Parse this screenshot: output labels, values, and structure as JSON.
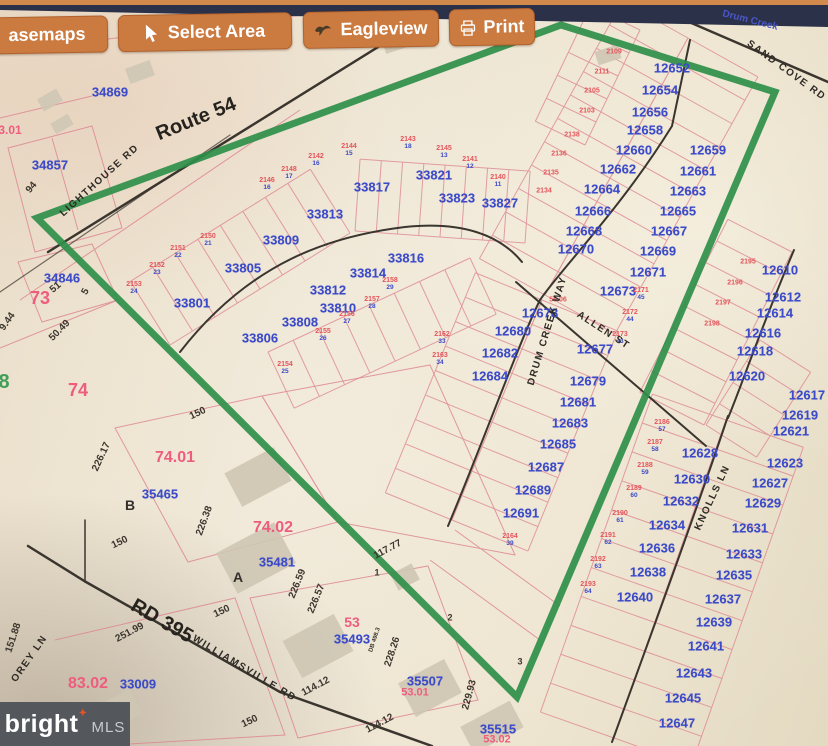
{
  "toolbar": {
    "buttons": [
      {
        "label": "asemaps",
        "icon": "none"
      },
      {
        "label": "Select Area",
        "icon": "cursor"
      },
      {
        "label": "Eagleview",
        "icon": "eagle"
      },
      {
        "label": "Print",
        "icon": "printer"
      }
    ]
  },
  "watermark": {
    "brand": "bright",
    "star": "✦",
    "suffix": "MLS"
  },
  "selection": {
    "points": [
      [
        561,
        25
      ],
      [
        775,
        92
      ],
      [
        517,
        697
      ],
      [
        37,
        218
      ]
    ],
    "color": "#2f8f4a",
    "width": 7
  },
  "colors": {
    "parcel_blue": "#3b4ac8",
    "lot_red": "#e4555c",
    "section_pink": "#ee5c7e",
    "toolbar_orange": "#cb7a40",
    "top_band_navy": "#2b3149",
    "paper_tan": "#ece3d0"
  },
  "map_labels": {
    "parcels": [
      {
        "t": "34869",
        "x": 110,
        "y": 92
      },
      {
        "t": "34857",
        "x": 50,
        "y": 165
      },
      {
        "t": "34846",
        "x": 62,
        "y": 278
      },
      {
        "t": "33801",
        "x": 192,
        "y": 303
      },
      {
        "t": "33805",
        "x": 243,
        "y": 268
      },
      {
        "t": "33809",
        "x": 281,
        "y": 240
      },
      {
        "t": "33813",
        "x": 325,
        "y": 214
      },
      {
        "t": "33817",
        "x": 372,
        "y": 187
      },
      {
        "t": "33821",
        "x": 434,
        "y": 175
      },
      {
        "t": "33823",
        "x": 457,
        "y": 198
      },
      {
        "t": "33827",
        "x": 500,
        "y": 203
      },
      {
        "t": "33806",
        "x": 260,
        "y": 338
      },
      {
        "t": "33808",
        "x": 300,
        "y": 322
      },
      {
        "t": "33810",
        "x": 338,
        "y": 308
      },
      {
        "t": "33812",
        "x": 328,
        "y": 290
      },
      {
        "t": "33814",
        "x": 368,
        "y": 273
      },
      {
        "t": "33816",
        "x": 406,
        "y": 258
      },
      {
        "t": "12652",
        "x": 672,
        "y": 68
      },
      {
        "t": "12654",
        "x": 660,
        "y": 90
      },
      {
        "t": "12656",
        "x": 650,
        "y": 112
      },
      {
        "t": "12658",
        "x": 645,
        "y": 130
      },
      {
        "t": "12660",
        "x": 634,
        "y": 150
      },
      {
        "t": "12662",
        "x": 618,
        "y": 169
      },
      {
        "t": "12664",
        "x": 602,
        "y": 189
      },
      {
        "t": "12666",
        "x": 593,
        "y": 211
      },
      {
        "t": "12668",
        "x": 584,
        "y": 231
      },
      {
        "t": "12670",
        "x": 576,
        "y": 249
      },
      {
        "t": "12659",
        "x": 708,
        "y": 150
      },
      {
        "t": "12661",
        "x": 698,
        "y": 171
      },
      {
        "t": "12663",
        "x": 688,
        "y": 191
      },
      {
        "t": "12665",
        "x": 678,
        "y": 211
      },
      {
        "t": "12667",
        "x": 669,
        "y": 231
      },
      {
        "t": "12669",
        "x": 658,
        "y": 251
      },
      {
        "t": "12671",
        "x": 648,
        "y": 272
      },
      {
        "t": "12673",
        "x": 618,
        "y": 291
      },
      {
        "t": "12677",
        "x": 595,
        "y": 349
      },
      {
        "t": "12678",
        "x": 540,
        "y": 313
      },
      {
        "t": "12680",
        "x": 513,
        "y": 331
      },
      {
        "t": "12682",
        "x": 500,
        "y": 353
      },
      {
        "t": "12684",
        "x": 490,
        "y": 376
      },
      {
        "t": "12679",
        "x": 588,
        "y": 381
      },
      {
        "t": "12681",
        "x": 578,
        "y": 402
      },
      {
        "t": "12683",
        "x": 570,
        "y": 423
      },
      {
        "t": "12685",
        "x": 558,
        "y": 444
      },
      {
        "t": "12687",
        "x": 546,
        "y": 467
      },
      {
        "t": "12689",
        "x": 533,
        "y": 490
      },
      {
        "t": "12691",
        "x": 521,
        "y": 513
      },
      {
        "t": "12610",
        "x": 780,
        "y": 270
      },
      {
        "t": "12612",
        "x": 783,
        "y": 297
      },
      {
        "t": "12614",
        "x": 775,
        "y": 313
      },
      {
        "t": "12616",
        "x": 763,
        "y": 333
      },
      {
        "t": "12618",
        "x": 755,
        "y": 351
      },
      {
        "t": "12620",
        "x": 747,
        "y": 376
      },
      {
        "t": "12617",
        "x": 807,
        "y": 395
      },
      {
        "t": "12619",
        "x": 800,
        "y": 415
      },
      {
        "t": "12621",
        "x": 791,
        "y": 431
      },
      {
        "t": "12623",
        "x": 785,
        "y": 463
      },
      {
        "t": "12627",
        "x": 770,
        "y": 483
      },
      {
        "t": "12629",
        "x": 763,
        "y": 503
      },
      {
        "t": "12631",
        "x": 750,
        "y": 528
      },
      {
        "t": "12633",
        "x": 744,
        "y": 554
      },
      {
        "t": "12635",
        "x": 734,
        "y": 575
      },
      {
        "t": "12637",
        "x": 723,
        "y": 599
      },
      {
        "t": "12639",
        "x": 714,
        "y": 622
      },
      {
        "t": "12641",
        "x": 706,
        "y": 646
      },
      {
        "t": "12643",
        "x": 694,
        "y": 673
      },
      {
        "t": "12645",
        "x": 683,
        "y": 698
      },
      {
        "t": "12647",
        "x": 677,
        "y": 723
      },
      {
        "t": "12628",
        "x": 700,
        "y": 453
      },
      {
        "t": "12630",
        "x": 692,
        "y": 479
      },
      {
        "t": "12632",
        "x": 681,
        "y": 501
      },
      {
        "t": "12634",
        "x": 667,
        "y": 525
      },
      {
        "t": "12636",
        "x": 657,
        "y": 548
      },
      {
        "t": "12638",
        "x": 648,
        "y": 572
      },
      {
        "t": "12640",
        "x": 635,
        "y": 597
      },
      {
        "t": "35465",
        "x": 160,
        "y": 494
      },
      {
        "t": "35481",
        "x": 277,
        "y": 562
      },
      {
        "t": "35493",
        "x": 352,
        "y": 639
      },
      {
        "t": "35507",
        "x": 425,
        "y": 681
      },
      {
        "t": "35515",
        "x": 498,
        "y": 729
      },
      {
        "t": "33009",
        "x": 138,
        "y": 684
      }
    ],
    "sections": [
      {
        "t": "3.01",
        "x": 10,
        "y": 130,
        "s": 12
      },
      {
        "t": "73",
        "x": 40,
        "y": 298,
        "s": 18
      },
      {
        "t": "74",
        "x": 78,
        "y": 390,
        "s": 18
      },
      {
        "t": "74.01",
        "x": 175,
        "y": 458,
        "s": 16
      },
      {
        "t": "74.02",
        "x": 273,
        "y": 528,
        "s": 16
      },
      {
        "t": "53",
        "x": 352,
        "y": 622,
        "s": 14
      },
      {
        "t": "83.02",
        "x": 88,
        "y": 684,
        "s": 16
      },
      {
        "t": "53.01",
        "x": 415,
        "y": 693,
        "s": 11
      },
      {
        "t": "53.02",
        "x": 497,
        "y": 740,
        "s": 11
      }
    ],
    "lots": [
      {
        "t": "2146",
        "x": 267,
        "y": 184,
        "b": "16"
      },
      {
        "t": "2148",
        "x": 289,
        "y": 173,
        "b": "17"
      },
      {
        "t": "2142",
        "x": 316,
        "y": 160,
        "b": "16"
      },
      {
        "t": "2144",
        "x": 349,
        "y": 150,
        "b": "15"
      },
      {
        "t": "2143",
        "x": 408,
        "y": 143,
        "b": "18"
      },
      {
        "t": "2145",
        "x": 444,
        "y": 152,
        "b": "13"
      },
      {
        "t": "2141",
        "x": 470,
        "y": 163,
        "b": "12"
      },
      {
        "t": "2140",
        "x": 498,
        "y": 181,
        "b": "11"
      },
      {
        "t": "2150",
        "x": 208,
        "y": 240,
        "b": "21"
      },
      {
        "t": "2151",
        "x": 178,
        "y": 252,
        "b": "22"
      },
      {
        "t": "2152",
        "x": 157,
        "y": 269,
        "b": "23"
      },
      {
        "t": "2153",
        "x": 134,
        "y": 288,
        "b": "24"
      },
      {
        "t": "2158",
        "x": 390,
        "y": 284,
        "b": "29"
      },
      {
        "t": "2157",
        "x": 372,
        "y": 303,
        "b": "28"
      },
      {
        "t": "2156",
        "x": 347,
        "y": 318,
        "b": "27"
      },
      {
        "t": "2155",
        "x": 323,
        "y": 335,
        "b": "26"
      },
      {
        "t": "2154",
        "x": 285,
        "y": 368,
        "b": "25"
      },
      {
        "t": "2162",
        "x": 442,
        "y": 338,
        "b": "33"
      },
      {
        "t": "2163",
        "x": 440,
        "y": 359,
        "b": "34"
      },
      {
        "t": "2164",
        "x": 510,
        "y": 540,
        "b": "39"
      },
      {
        "t": "2109",
        "x": 614,
        "y": 52
      },
      {
        "t": "2111",
        "x": 602,
        "y": 72
      },
      {
        "t": "2105",
        "x": 592,
        "y": 91
      },
      {
        "t": "2103",
        "x": 587,
        "y": 111
      },
      {
        "t": "2138",
        "x": 572,
        "y": 135
      },
      {
        "t": "2136",
        "x": 559,
        "y": 154
      },
      {
        "t": "2135",
        "x": 551,
        "y": 173
      },
      {
        "t": "2134",
        "x": 544,
        "y": 191
      },
      {
        "t": "2171",
        "x": 641,
        "y": 294,
        "b": "45"
      },
      {
        "t": "2172",
        "x": 630,
        "y": 316,
        "b": "44"
      },
      {
        "t": "2173",
        "x": 620,
        "y": 338,
        "b": "43"
      },
      {
        "t": "2186",
        "x": 662,
        "y": 426,
        "b": "57"
      },
      {
        "t": "2187",
        "x": 655,
        "y": 446,
        "b": "58"
      },
      {
        "t": "2188",
        "x": 645,
        "y": 469,
        "b": "59"
      },
      {
        "t": "2189",
        "x": 634,
        "y": 492,
        "b": "60"
      },
      {
        "t": "2190",
        "x": 620,
        "y": 517,
        "b": "61"
      },
      {
        "t": "2191",
        "x": 608,
        "y": 539,
        "b": "62"
      },
      {
        "t": "2192",
        "x": 598,
        "y": 563,
        "b": "63"
      },
      {
        "t": "2193",
        "x": 588,
        "y": 588,
        "b": "64"
      },
      {
        "t": "2195",
        "x": 748,
        "y": 262
      },
      {
        "t": "2196",
        "x": 735,
        "y": 283
      },
      {
        "t": "2197",
        "x": 723,
        "y": 303
      },
      {
        "t": "2198",
        "x": 712,
        "y": 324
      },
      {
        "t": "56.06",
        "x": 558,
        "y": 300
      }
    ],
    "dims": [
      {
        "t": "150",
        "x": 198,
        "y": 414,
        "r": -25
      },
      {
        "t": "150",
        "x": 120,
        "y": 543,
        "r": -25
      },
      {
        "t": "150",
        "x": 222,
        "y": 612,
        "r": -25
      },
      {
        "t": "150",
        "x": 250,
        "y": 722,
        "r": -25
      },
      {
        "t": "226.17",
        "x": 102,
        "y": 457,
        "r": -65
      },
      {
        "t": "226.38",
        "x": 205,
        "y": 521,
        "r": -70
      },
      {
        "t": "226.59",
        "x": 298,
        "y": 584,
        "r": -68
      },
      {
        "t": "226.57",
        "x": 317,
        "y": 599,
        "r": -68
      },
      {
        "t": "117.77",
        "x": 388,
        "y": 550,
        "r": -28
      },
      {
        "t": "228.26",
        "x": 393,
        "y": 652,
        "r": -72
      },
      {
        "t": "114.12",
        "x": 316,
        "y": 687,
        "r": -28
      },
      {
        "t": "114.12",
        "x": 380,
        "y": 724,
        "r": -28
      },
      {
        "t": "229.93",
        "x": 470,
        "y": 695,
        "r": -75
      },
      {
        "t": "50.49",
        "x": 60,
        "y": 331,
        "r": -45
      },
      {
        "t": "9.44",
        "x": 8,
        "y": 322,
        "r": -55
      },
      {
        "t": "51",
        "x": 56,
        "y": 288,
        "r": -40
      },
      {
        "t": "5",
        "x": 86,
        "y": 292,
        "r": -60
      },
      {
        "t": "151.88",
        "x": 14,
        "y": 638,
        "r": -72
      },
      {
        "t": "251.99",
        "x": 130,
        "y": 633,
        "r": -28
      },
      {
        "t": "94",
        "x": 32,
        "y": 188,
        "r": -50
      },
      {
        "t": "DB 498.3",
        "x": 375,
        "y": 640,
        "r": -72,
        "s": 6
      },
      {
        "t": "1",
        "x": 377,
        "y": 573,
        "r": 0,
        "s": 9
      },
      {
        "t": "2",
        "x": 450,
        "y": 618,
        "r": 0,
        "s": 9
      },
      {
        "t": "3",
        "x": 520,
        "y": 662,
        "r": 0,
        "s": 9
      }
    ],
    "roads": [
      {
        "t": "Route 54",
        "x": 196,
        "y": 119,
        "r": -22,
        "lg": true
      },
      {
        "t": "LIGHTHOUSE RD",
        "x": 100,
        "y": 181,
        "r": -42
      },
      {
        "t": "SAND COVE RD",
        "x": 786,
        "y": 71,
        "r": 36
      },
      {
        "t": "DRUM CREEK WAY",
        "x": 548,
        "y": 331,
        "r": -73
      },
      {
        "t": "ALLEN ST",
        "x": 603,
        "y": 331,
        "r": 33
      },
      {
        "t": "KNOLLS LN",
        "x": 713,
        "y": 498,
        "r": -65
      },
      {
        "t": "RD 395",
        "x": 162,
        "y": 621,
        "r": 30,
        "lg": true
      },
      {
        "t": "WILLIAMSVILLE RD",
        "x": 244,
        "y": 669,
        "r": 31
      },
      {
        "t": "OREY LN",
        "x": 30,
        "y": 659,
        "r": -55
      }
    ],
    "letters": [
      {
        "t": "B",
        "x": 130,
        "y": 505
      },
      {
        "t": "A",
        "x": 238,
        "y": 577
      }
    ],
    "misc": [
      {
        "t": "8",
        "x": 4,
        "y": 382,
        "c": "#3f9e57",
        "s": 20,
        "r": 0
      },
      {
        "t": "Drum Creek",
        "x": 750,
        "y": 21,
        "c": "#4a56c8",
        "s": 10,
        "r": 14
      }
    ]
  }
}
